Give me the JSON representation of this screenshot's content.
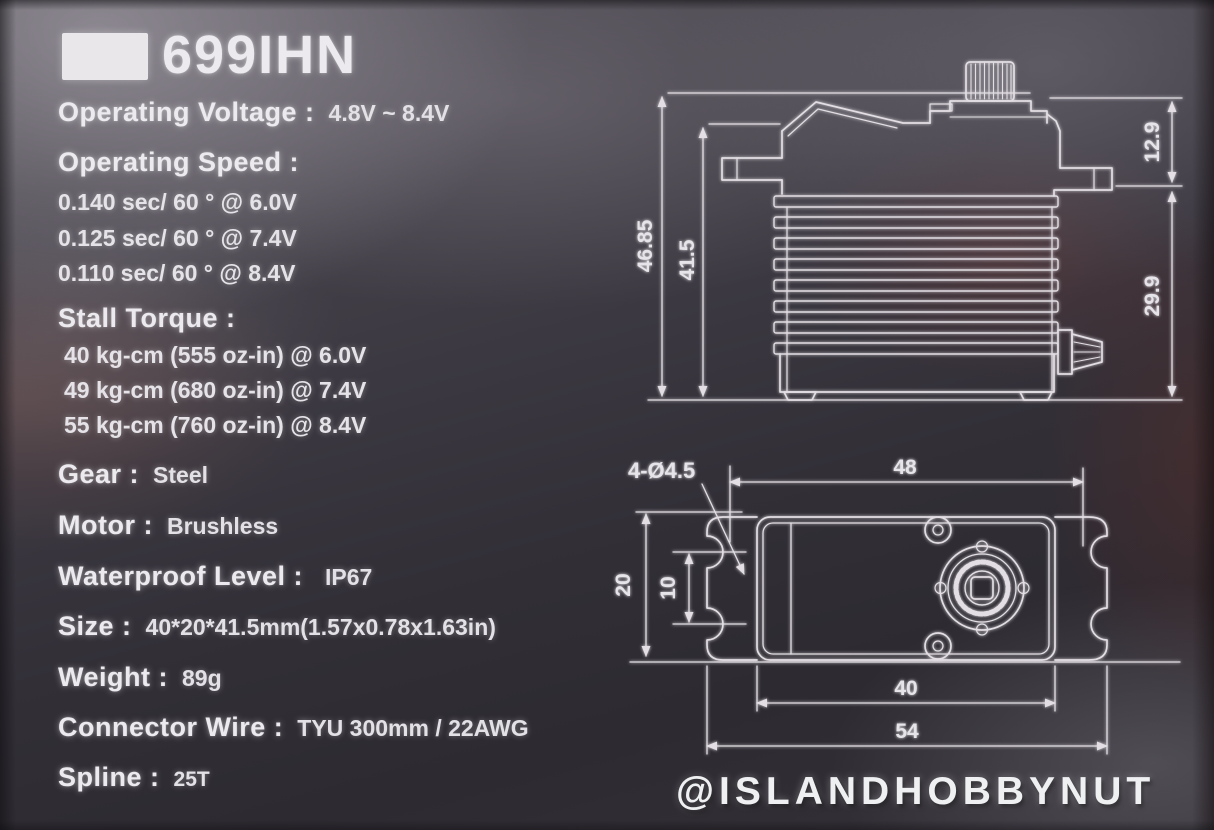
{
  "model": "699IHN",
  "ink_color": "#e8e5e9",
  "specs": [
    {
      "label": "Operating Voltage :",
      "value": "4.8V ~ 8.4V"
    },
    {
      "label": "Operating Speed :",
      "lines": [
        "0.140 sec/ 60 ° @ 6.0V",
        "0.125 sec/ 60 ° @ 7.4V",
        "0.110 sec/ 60 ° @ 8.4V"
      ]
    },
    {
      "label": "Stall Torque :",
      "lines": [
        "40 kg-cm (555 oz-in) @ 6.0V",
        "49 kg-cm (680 oz-in) @ 7.4V",
        "55 kg-cm (760 oz-in) @ 8.4V"
      ]
    },
    {
      "label": "Gear :",
      "value": "Steel"
    },
    {
      "label": "Motor :",
      "value": "Brushless"
    },
    {
      "label": "Waterproof Level :",
      "value": "IP67"
    },
    {
      "label": "Size :",
      "value": "40*20*41.5mm(1.57x0.78x1.63in)"
    },
    {
      "label": "Weight :",
      "value": "89g"
    },
    {
      "label": "Connector Wire :",
      "value": "TYU 300mm / 22AWG"
    },
    {
      "label": "Spline :",
      "value": "25T"
    }
  ],
  "drawings": {
    "side_view": {
      "overall_height": "46.85",
      "case_height": "41.5",
      "upper_section": "12.9",
      "lower_section": "29.9"
    },
    "top_view": {
      "hole_note": "4-Ø4.5",
      "hole_span": "48",
      "case_depth": "20",
      "hole_pitch": "10",
      "case_width": "40",
      "flange_span": "54"
    }
  },
  "watermark": "@ISLANDHOBBYNUT"
}
